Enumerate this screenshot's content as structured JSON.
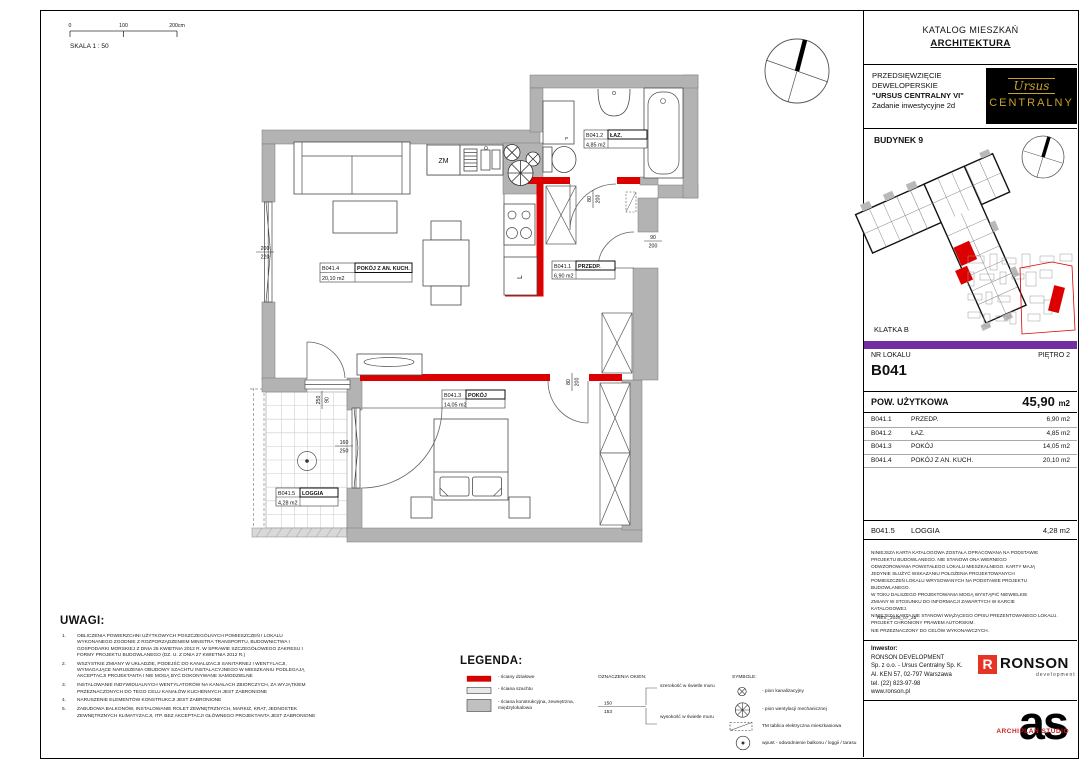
{
  "header": {
    "catalog_title": "KATALOG MIESZKAŃ",
    "subtitle": "ARCHITEKTURA"
  },
  "project": {
    "line1": "PRZEDSIĘWZIĘCIE",
    "line2": "DEWELOPERSKIE",
    "line3": "\"URSUS CENTRALNY VI\"",
    "line4": "Zadanie inwestycyjne 2d",
    "logo_top": "Ursus",
    "logo_bottom": "CENTRALNY"
  },
  "building": {
    "name": "BUDYNEK 9",
    "staircase": "KLATKA B"
  },
  "unit": {
    "nr_label": "NR LOKALU",
    "floor": "PIĘTRO 2",
    "number": "B041",
    "area_label": "POW. UŻYTKOWA",
    "area_value": "45,90",
    "area_unit": "m2"
  },
  "rooms": [
    {
      "code": "B041.1",
      "name": "PRZEDP.",
      "area": "6,90 m2"
    },
    {
      "code": "B041.2",
      "name": "ŁAZ.",
      "area": "4,85 m2"
    },
    {
      "code": "B041.3",
      "name": "POKÓJ",
      "area": "14,05 m2"
    },
    {
      "code": "B041.4",
      "name": "POKÓJ Z AN. KUCH.",
      "area": "20,10 m2"
    }
  ],
  "loggia_row": {
    "code": "B041.5",
    "name": "LOGGIA",
    "area": "4,28 m2"
  },
  "disclaimer": {
    "text": "NINIEJSZA KARTA KATALOGOWA ZOSTAŁA OPRACOWANA NA PODSTAWIE\nPROJEKTU BUDOWLANEGO. NIE STANOWI ONA WIERNEGO\nODWZOROWANIA POWSTAŁEGO LOKALU MIESZKALNEGO. KARTY MAJĄ\nJEDYNIE SŁUŻYĆ WSKAZANIU POŁOŻENIA PROJEKTOWANYCH\nPOMIESZCZEŃ LOKALU WRYSOWANYCH NA PODSTAWIE PROJEKTU\nBUDOWLANEGO.\nW TOKU DALSZEGO PROJEKTOWANIA MOGĄ WYSTĄPIĆ NIEWIELKIE\nZMIANY W STOSUNKU DO INFORMACJI ZAWARTYCH W KARCIE\nKATALOGOWEJ.\nNINIEJSZA KARTA NIE STANOWI WIĄŻĄCEGO OPISU PREZENTOWANEGO LOKALU.\nPROJEKT CHRONIONY PRAWEM AUTORSKIM.\nNIE PRZEZNACZONY DO CELÓW WYKONAWCZYCH.",
    "rev": "REV._2025_07_25"
  },
  "investor": {
    "heading": "Inwestor:",
    "text": "RONSON DEVELOPMENT\nSp. z o.o. - Ursus Centralny Sp. K.\nAl. KEN 57, 02-797 Warszawa\ntel. (22) 823-97-98\nwww.ronson.pl",
    "ronson_r": "R",
    "ronson_name": "RONSON",
    "ronson_sub": "development"
  },
  "archiplan": {
    "letters": "as",
    "studio": "ARCHIPLAN STUDIO"
  },
  "scalebar": {
    "t0": "0",
    "t1": "100",
    "t2": "200cm",
    "title": "SKALA 1 : 50"
  },
  "uwagi": {
    "title": "UWAGI:",
    "items": [
      {
        "num": "1.",
        "text": "OBLICZENIA POWIERZCHNI UŻYTKOWYCH POSZCZEGÓLNYCH POMIESZCZEŃ I LOKALU WYKONANEGO ZGODNIE Z ROZPORZĄDZENIEM MINISTRA TRANSPORTU, BUDOWNICTWA I GOSPODARKI MORSKIEJ Z DNIA 25 KWIETNIA 2012 R. W SPRAWIE SZCZEGÓŁOWEGO ZAKRESU I FORMY PROJEKTU BUDOWLANEGO (DZ. U. Z DNIA 27 KWIETNIA 2012 R.)"
      },
      {
        "num": "2.",
        "text": "WSZYSTKIE ZMIANY W UKŁADZIE, PODEJŚĆ DO KANALIZACJI SANITARNEJ I WENTYLACJI, WYMAGAJĄCE NARUSZENIA OBUDOWY SZACHTU INSTALACYJNEGO W MIESZKANIU PODLEGAJĄ AKCEPTACJI PROJEKTANTA I NIE MOGĄ BYĆ DOKONYWANE SAMODZIELNE"
      },
      {
        "num": "3.",
        "text": "INSTALOWANIE INDYWIDUALNYCH WENTYLATORÓW NA KANAŁACH ZBIORCZYCH, ZA WYJĄTKIEM PRZEZNACZONYCH DO TEGO CELU KANAŁÓW KUCHENNYCH JEST ZABRONIONE"
      },
      {
        "num": "4.",
        "text": "NARUSZENIE ELEMENTÓW KONSTRUKCJI JEST ZABRONIONE"
      },
      {
        "num": "5.",
        "text": "ZABUDOWA BALKONÓW, INSTALOWANIE ROLET ZEWNĘTRZNYCH, MARKIZ, KRAT, JEDNOSTEK ZEWNĘTRZNYCH KLIMATYZACJI, ITP. BEZ AKCEPTACJI GŁÓWNEGO PROJEKTANTA JEST ZABRONIONE"
      }
    ]
  },
  "legenda": {
    "title": "LEGENDA:",
    "walls": [
      {
        "label": "- ściany działowe"
      },
      {
        "label": "- ściana szachtu"
      },
      {
        "label": "- ściana konstrukcyjna, zewnętrzna,\nmiędzylokalowa"
      }
    ],
    "okna": {
      "title": "OZNACZENIA OKIEN:",
      "width_label": "szerokość w świetle muru",
      "height_label": "wysokość w świetle muru",
      "w": "150",
      "h": "153"
    },
    "symbole": {
      "title": "SYMBOLE:",
      "items": [
        "- pion kanalizacyjny",
        "- pion wentylacji mechanicznej",
        "TM    tablica elektryczna mieszkaniowa",
        "wpust - odwodnienie balkonu / loggii / tarasu"
      ]
    }
  },
  "plan": {
    "labels": {
      "b041_4": {
        "code": "B041.4",
        "name": "POKÓJ Z AN. KUCH.",
        "area": "20,10 m2"
      },
      "b041_2": {
        "code": "B041.2",
        "name": "ŁAZ.",
        "area": "4,85 m2"
      },
      "b041_1": {
        "code": "B041.1",
        "name": "PRZEDP.",
        "area": "6,90 m2"
      },
      "b041_3": {
        "code": "B041.3",
        "name": "POKÓJ",
        "area": "14,05 m2"
      },
      "b041_5": {
        "code": "B041.5",
        "name": "LOGGIA",
        "area": "4,28 m2"
      }
    },
    "appliances": {
      "dishwasher": "ZM",
      "fridge": "L",
      "washer": "P"
    },
    "dims": {
      "window": {
        "a": "200",
        "b": "220"
      },
      "bath_door": {
        "a": "80",
        "b": "200"
      },
      "entry_door": {
        "a": "90",
        "b": "200"
      },
      "bed_door": {
        "a": "80",
        "b": "200"
      },
      "loggia_door": {
        "a": "250",
        "b": "90"
      },
      "loggia_window": {
        "a": "160",
        "b": "250"
      }
    }
  },
  "colors": {
    "wall_gray": "#b3b3b3",
    "partition_red": "#dd0000",
    "accent_purple": "#7030a0",
    "logo_gold": "#c9a227"
  }
}
